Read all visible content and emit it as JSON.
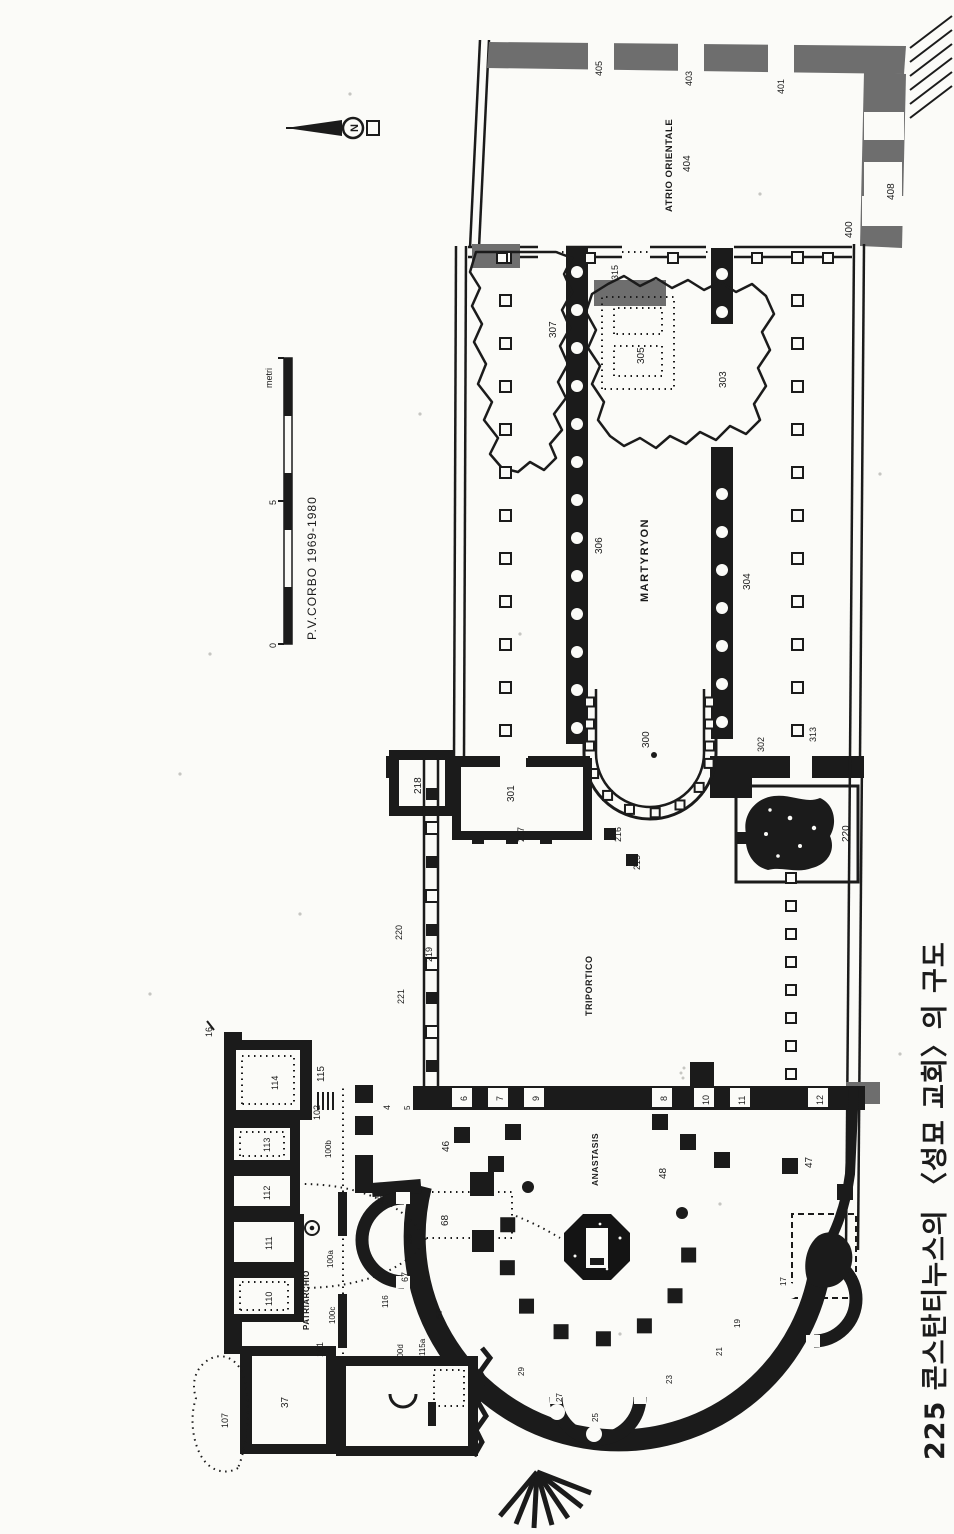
{
  "page": {
    "caption": "225 콘스탄티누스의 〈성묘 교회〉의 구도"
  },
  "compass": {
    "label": "N"
  },
  "scale_bar": {
    "credit": "P.V.CORBO 1969-1980",
    "unit": "metri",
    "tick_0": "0",
    "tick_5": "5"
  },
  "areas": {
    "atrium": "ATRIO ORIENTALE",
    "basilica": "MARTYRYON",
    "courtyard": "TRIPORTICO",
    "rotunda": "ANASTASIS",
    "patriarchate": "PATRIARCHIO"
  },
  "colors": {
    "ink": "#1b1b1b",
    "gray_wall": "#6e6e6e",
    "paper": "#fbfbf8"
  },
  "labels": [
    {
      "t": "405",
      "x": 1458,
      "y": 602,
      "fs": 9
    },
    {
      "t": "403",
      "x": 1448,
      "y": 692,
      "fs": 9
    },
    {
      "t": "401",
      "x": 1440,
      "y": 784,
      "fs": 9
    },
    {
      "t": "400",
      "x": 1296,
      "y": 852,
      "fs": 10
    },
    {
      "t": "408",
      "x": 1334,
      "y": 894,
      "fs": 10
    },
    {
      "t": "404",
      "x": 1362,
      "y": 690,
      "fs": 10
    },
    {
      "t": "315",
      "x": 1254,
      "y": 618,
      "fs": 9
    },
    {
      "t": "307",
      "x": 1196,
      "y": 556,
      "fs": 10
    },
    {
      "t": "305",
      "x": 1170,
      "y": 644,
      "fs": 10
    },
    {
      "t": "303",
      "x": 1146,
      "y": 726,
      "fs": 10
    },
    {
      "t": "306",
      "x": 980,
      "y": 602,
      "fs": 10
    },
    {
      "t": "304",
      "x": 944,
      "y": 750,
      "fs": 10
    },
    {
      "t": "313",
      "x": 792,
      "y": 816,
      "fs": 9
    },
    {
      "t": "302",
      "x": 782,
      "y": 764,
      "fs": 9
    },
    {
      "t": "300",
      "x": 786,
      "y": 649,
      "fs": 10
    },
    {
      "t": "301",
      "x": 732,
      "y": 514,
      "fs": 10
    },
    {
      "t": "217",
      "x": 692,
      "y": 524,
      "fs": 9
    },
    {
      "t": "218",
      "x": 740,
      "y": 421,
      "fs": 10
    },
    {
      "t": "216",
      "x": 692,
      "y": 621,
      "fs": 9
    },
    {
      "t": "215",
      "x": 664,
      "y": 640,
      "fs": 9
    },
    {
      "t": "220",
      "x": 692,
      "y": 849,
      "fs": 10
    },
    {
      "t": "219",
      "x": 572,
      "y": 432,
      "fs": 9
    },
    {
      "t": "221",
      "x": 530,
      "y": 404,
      "fs": 9
    },
    {
      "t": "220",
      "x": 594,
      "y": 402,
      "fs": 9
    },
    {
      "t": "16",
      "x": 497,
      "y": 212,
      "fs": 9
    },
    {
      "t": "6",
      "x": 433,
      "y": 467,
      "fs": 9
    },
    {
      "t": "7",
      "x": 433,
      "y": 503,
      "fs": 9
    },
    {
      "t": "9",
      "x": 433,
      "y": 539,
      "fs": 9
    },
    {
      "t": "8",
      "x": 433,
      "y": 667,
      "fs": 9
    },
    {
      "t": "10",
      "x": 429,
      "y": 709,
      "fs": 9
    },
    {
      "t": "11",
      "x": 429,
      "y": 745,
      "fs": 9
    },
    {
      "t": "12",
      "x": 429,
      "y": 823,
      "fs": 9
    },
    {
      "t": "4",
      "x": 424,
      "y": 390,
      "fs": 9
    },
    {
      "t": "5",
      "x": 424,
      "y": 410,
      "fs": 8
    },
    {
      "t": "46",
      "x": 382,
      "y": 449,
      "fs": 10
    },
    {
      "t": "48",
      "x": 355,
      "y": 666,
      "fs": 10
    },
    {
      "t": "47",
      "x": 366,
      "y": 812,
      "fs": 10
    },
    {
      "t": "43",
      "x": 329,
      "y": 384,
      "fs": 9
    },
    {
      "t": "68",
      "x": 308,
      "y": 448,
      "fs": 10
    },
    {
      "t": "39",
      "x": 290,
      "y": 412,
      "fs": 9
    },
    {
      "t": "67",
      "x": 252,
      "y": 408,
      "fs": 9
    },
    {
      "t": "57",
      "x": 215,
      "y": 442,
      "fs": 9
    },
    {
      "t": "116",
      "x": 226,
      "y": 388,
      "fs": 8
    },
    {
      "t": "29",
      "x": 158,
      "y": 524,
      "fs": 8
    },
    {
      "t": "27",
      "x": 132,
      "y": 562,
      "fs": 8
    },
    {
      "t": "25",
      "x": 112,
      "y": 598,
      "fs": 8
    },
    {
      "t": "23",
      "x": 150,
      "y": 672,
      "fs": 8
    },
    {
      "t": "21",
      "x": 178,
      "y": 722,
      "fs": 8
    },
    {
      "t": "19",
      "x": 206,
      "y": 740,
      "fs": 8
    },
    {
      "t": "17",
      "x": 248,
      "y": 786,
      "fs": 8
    },
    {
      "t": "114",
      "x": 444,
      "y": 278,
      "fs": 9
    },
    {
      "t": "113",
      "x": 382,
      "y": 270,
      "fs": 9
    },
    {
      "t": "112",
      "x": 334,
      "y": 270,
      "fs": 9
    },
    {
      "t": "111",
      "x": 284,
      "y": 272,
      "fs": 9
    },
    {
      "t": "110",
      "x": 228,
      "y": 272,
      "fs": 9
    },
    {
      "t": "115",
      "x": 452,
      "y": 324,
      "fs": 10
    },
    {
      "t": "102",
      "x": 414,
      "y": 320,
      "fs": 9
    },
    {
      "t": "100b",
      "x": 376,
      "y": 331,
      "fs": 8
    },
    {
      "t": "100a",
      "x": 266,
      "y": 333,
      "fs": 8
    },
    {
      "t": "100c",
      "x": 210,
      "y": 335,
      "fs": 8
    },
    {
      "t": "101",
      "x": 177,
      "y": 323,
      "fs": 9
    },
    {
      "t": "100d",
      "x": 172,
      "y": 403,
      "fs": 8
    },
    {
      "t": "115a",
      "x": 178,
      "y": 425,
      "fs": 8
    },
    {
      "t": "37",
      "x": 126,
      "y": 288,
      "fs": 10
    },
    {
      "t": "107",
      "x": 106,
      "y": 228,
      "fs": 9
    }
  ]
}
